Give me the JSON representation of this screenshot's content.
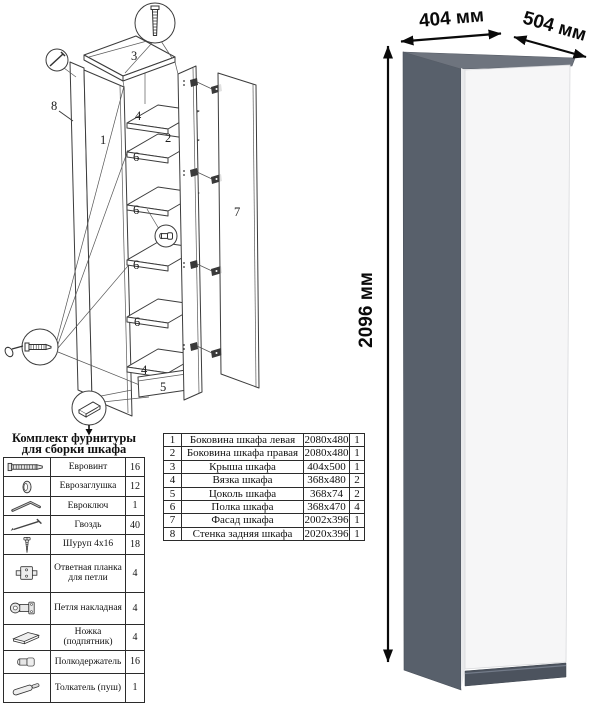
{
  "diagram": {
    "labels": {
      "p1": "1",
      "p2": "2",
      "p3": "3",
      "p4_top": "4",
      "p4_bottom": "4",
      "p5": "5",
      "p6": "6",
      "p7": "7",
      "p8": "8"
    }
  },
  "hardware_kit": {
    "title_line1": "Комплект фурнитуры",
    "title_line2": "для сборки шкафа",
    "rows": [
      {
        "icon": "confirmat-screw-icon",
        "name": "Евровинт",
        "qty": "16"
      },
      {
        "icon": "cap-plug-icon",
        "name": "Еврозаглушка",
        "qty": "12"
      },
      {
        "icon": "hex-key-icon",
        "name": "Евроключ",
        "qty": "1"
      },
      {
        "icon": "nail-icon",
        "name": "Гвоздь",
        "qty": "40"
      },
      {
        "icon": "screw-icon",
        "name": "Шуруп 4x16",
        "qty": "18"
      },
      {
        "icon": "hinge-plate-icon",
        "name": "Ответная планка для петли",
        "qty": "4"
      },
      {
        "icon": "hinge-icon",
        "name": "Петля накладная",
        "qty": "4"
      },
      {
        "icon": "foot-icon",
        "name": "Ножка (подпятник)",
        "qty": "4"
      },
      {
        "icon": "shelf-pin-icon",
        "name": "Полкодержатель",
        "qty": "16"
      },
      {
        "icon": "push-latch-icon",
        "name": "Толкатель (пуш)",
        "qty": "1"
      }
    ]
  },
  "parts_list": {
    "rows": [
      {
        "num": "1",
        "name": "Боковина шкафа левая",
        "size": "2080x480",
        "qty": "1"
      },
      {
        "num": "2",
        "name": "Боковина шкафа правая",
        "size": "2080x480",
        "qty": "1"
      },
      {
        "num": "3",
        "name": "Крыша шкафа",
        "size": "404x500",
        "qty": "1"
      },
      {
        "num": "4",
        "name": "Вязка шкафа",
        "size": "368x480",
        "qty": "2"
      },
      {
        "num": "5",
        "name": "Цоколь шкафа",
        "size": "368x74",
        "qty": "2"
      },
      {
        "num": "6",
        "name": "Полка шкафа",
        "size": "368x470",
        "qty": "4"
      },
      {
        "num": "7",
        "name": "Фасад шкафа",
        "size": "2002x396",
        "qty": "1"
      },
      {
        "num": "8",
        "name": "Стенка задняя шкафа",
        "size": "2020x396",
        "qty": "1"
      }
    ]
  },
  "render": {
    "width_label": "404 мм",
    "depth_label": "504 мм",
    "height_label": "2096 мм",
    "colors": {
      "side": "#58606b",
      "top": "#6e747e",
      "front": "#f6f6f7",
      "plinth": "#4c535e"
    }
  }
}
